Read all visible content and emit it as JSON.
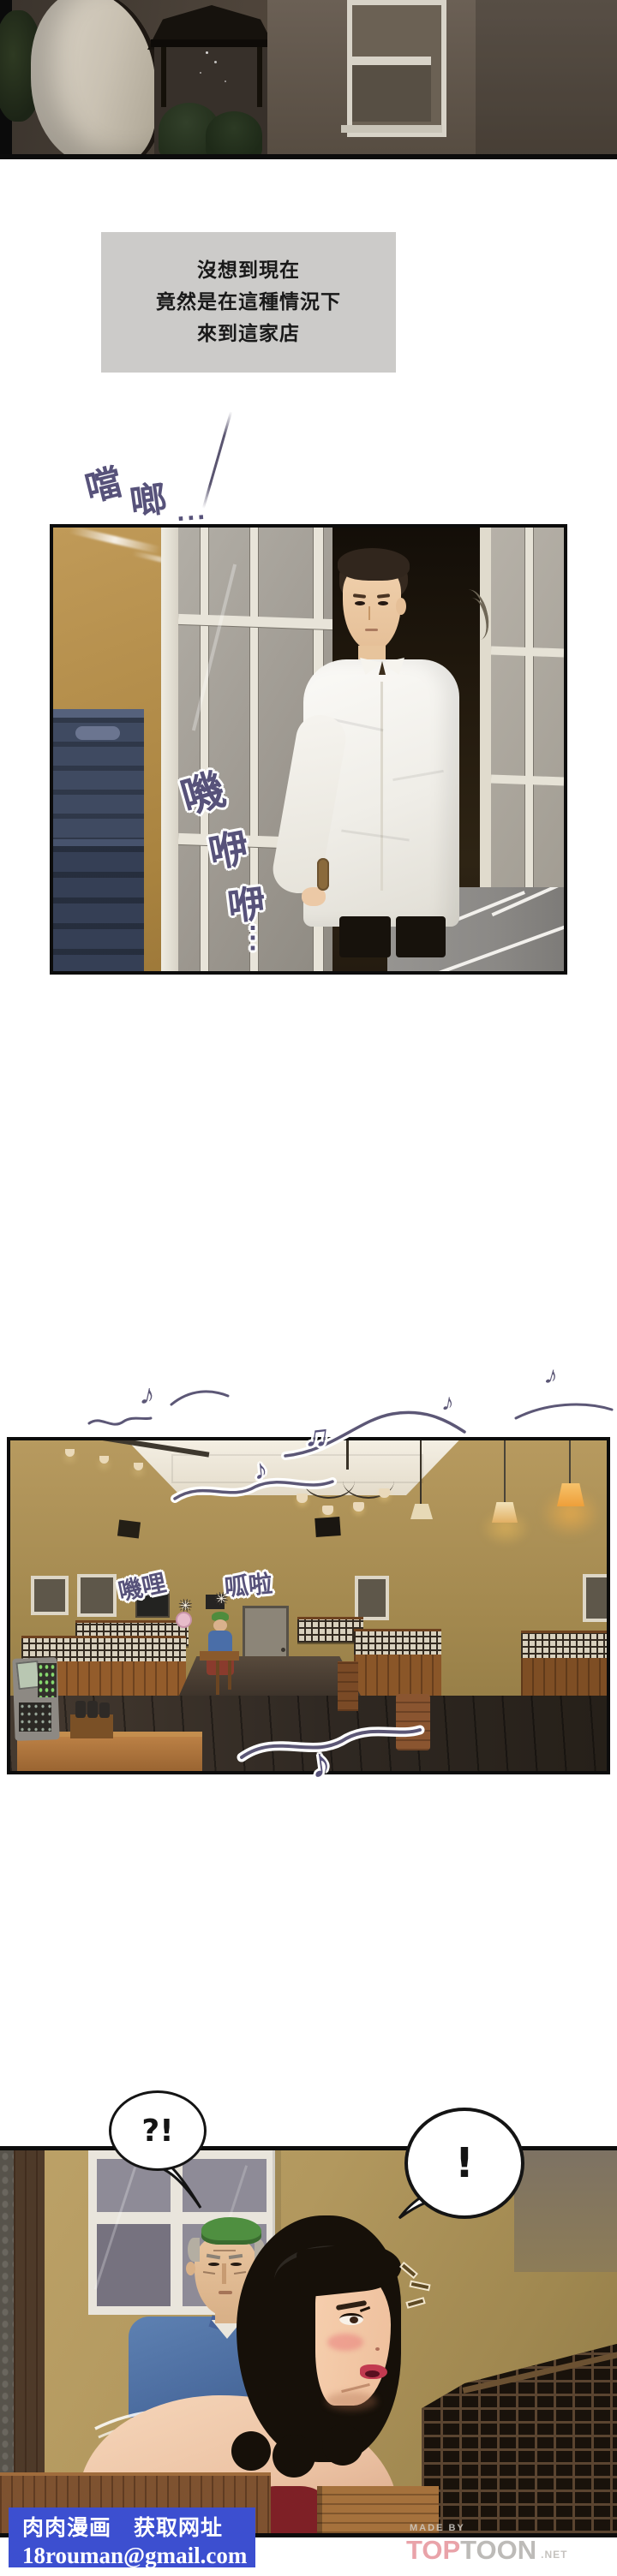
{
  "comic": {
    "narration": {
      "lines": [
        "沒想到現在",
        "竟然是在這種情況下",
        "來到這家店"
      ]
    },
    "sfx": {
      "door_chime_a": "噹",
      "door_chime_b": "啷",
      "door_chime_dots": "...",
      "door_creak": [
        "嘰",
        "咿",
        "咿"
      ],
      "door_creak_dots": "⋮",
      "chatter_a": "嘰哩",
      "chatter_b": "呱啦",
      "sparkle": "✳",
      "note": "♪",
      "note_double": "♫"
    },
    "bubbles": {
      "left": "?!",
      "right": "!"
    },
    "watermark": {
      "title": "肉肉漫画",
      "subtitle": "获取网址",
      "email": "18rouman@gmail.com",
      "bg_color": "#3c4fd0"
    },
    "branding": {
      "made_by": "MADE BY",
      "top": "TOP",
      "toon": "TOON",
      "net": ".NET",
      "top_color": "#e9a3a9",
      "toon_color": "#bdbbb8"
    }
  }
}
